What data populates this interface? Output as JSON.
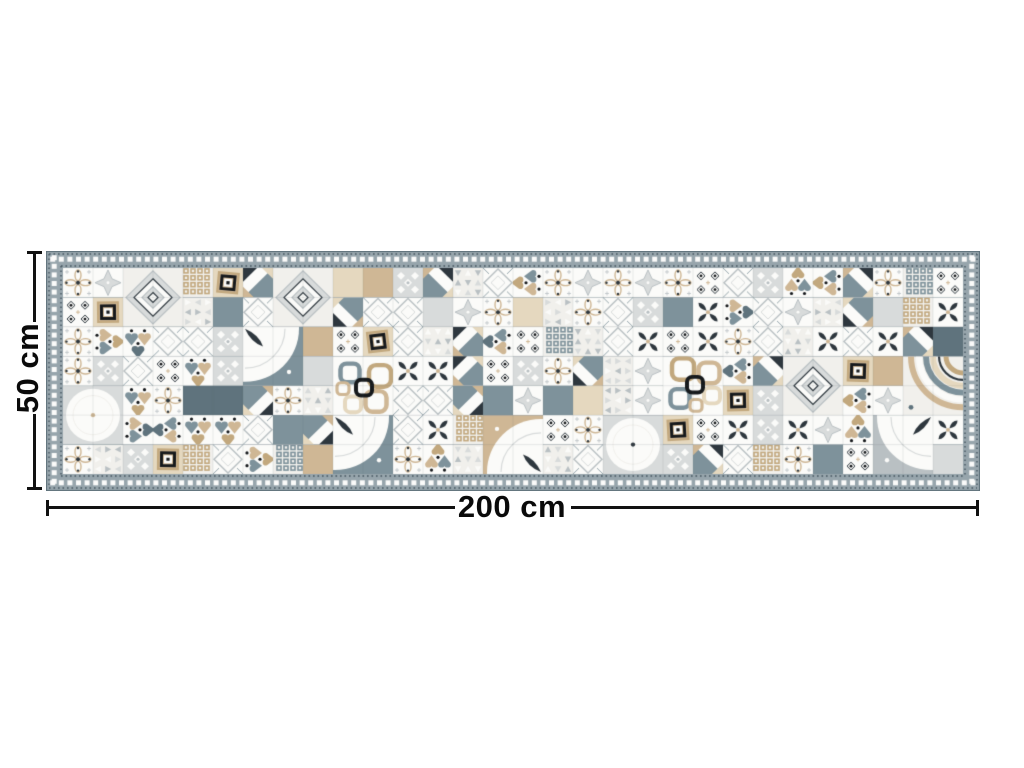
{
  "dimensions": {
    "height_label": "50 cm",
    "width_label": "200 cm",
    "line_color": "#111111"
  },
  "rug": {
    "border": {
      "edge_color": "#5d6f79",
      "band_color": "#97a5ac",
      "square_color": "#fbfbfa",
      "dot_color": "#45565f"
    },
    "palette": {
      "white": "#fbfbf9",
      "offwhite": "#f1f0ec",
      "light_gray": "#d8dbdb",
      "mid_gray": "#b9c0c3",
      "slate": "#7e929b",
      "slate_dark": "#5f737d",
      "beige": "#cfb795",
      "beige_light": "#e5d8bf",
      "tan": "#c2a87e",
      "charcoal": "#2e373e",
      "black": "#16191c"
    },
    "grid": {
      "cols": 30,
      "rows": 7,
      "seed": 13,
      "big_motifs": 12
    },
    "pattern_names": [
      "quarter-fan",
      "chain-squares",
      "corner-arcs",
      "big-diamond",
      "big-circle",
      "diamond-lattice",
      "floret",
      "tulips",
      "frame-diamond",
      "dot-eyes",
      "star-cross",
      "pinwheel",
      "triangle-scatter",
      "lace",
      "petal-star",
      "grid-squares",
      "solid"
    ]
  }
}
